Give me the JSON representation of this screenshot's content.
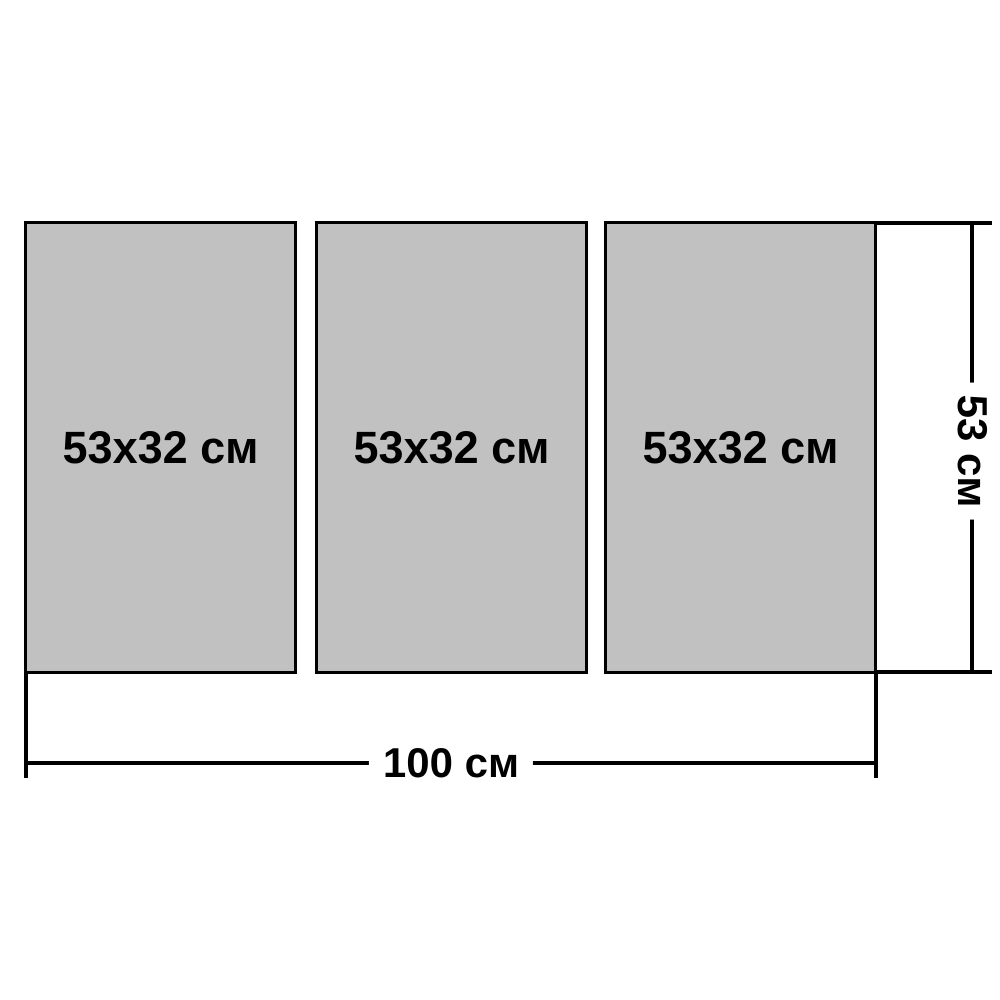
{
  "diagram": {
    "panels": [
      {
        "label": "53x32 см"
      },
      {
        "label": "53x32 см"
      },
      {
        "label": "53x32 см"
      }
    ],
    "dimensions": {
      "width_label": "100 см",
      "height_label": "53 см"
    },
    "colors": {
      "panel_fill": "#c1c1c1",
      "panel_border": "#000000",
      "line": "#000000",
      "background": "#ffffff"
    }
  }
}
